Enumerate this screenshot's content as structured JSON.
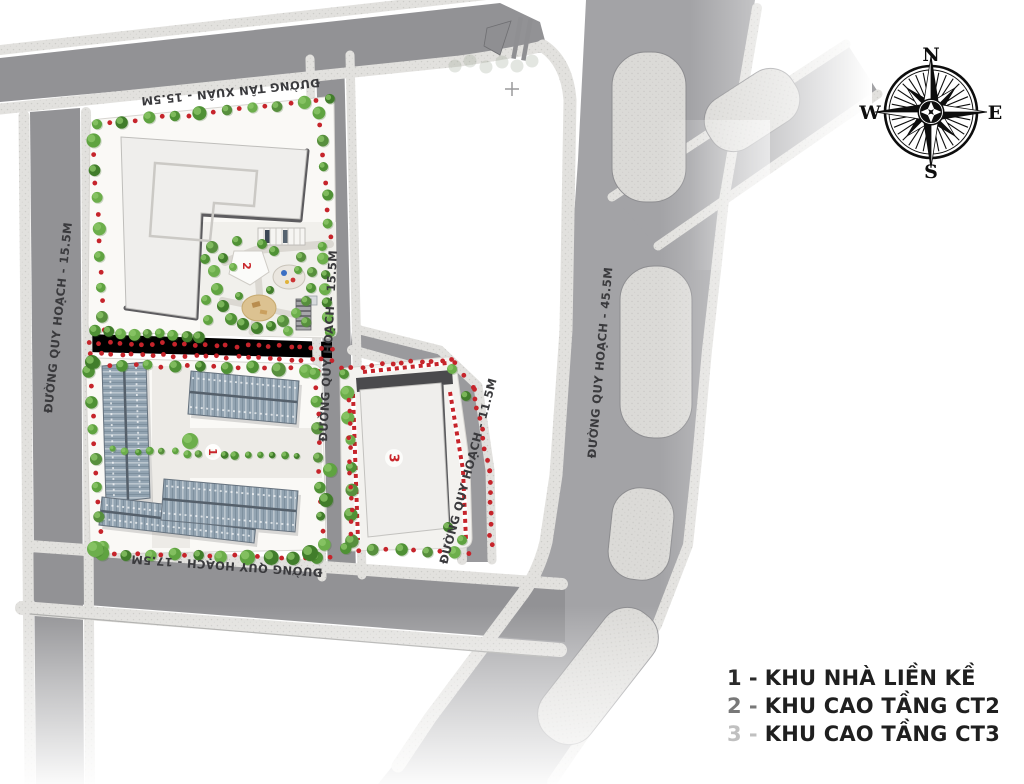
{
  "title": "Master plan site map",
  "roads": {
    "tan_xuan": "ĐƯỜNG TÂN XUÂN - 15.5M",
    "qh_15_left": "ĐƯỜNG QUY HOẠCH - 15.5M",
    "qh_15_mid": "ĐƯỜNG QUY HOẠCH - 15.5M",
    "qh_11": "ĐƯỜNG QUY HOẠCH - 11.5M",
    "qh_45": "ĐƯỜNG QUY HOẠCH - 45.5M",
    "qh_17": "ĐƯỜNG QUY HOẠCH - 17.5M"
  },
  "markers": {
    "block1": "1",
    "block2": "2",
    "block3": "3",
    "survey_cross": "+"
  },
  "legend": {
    "items": [
      {
        "num": "1",
        "sep": "-",
        "label": "KHU NHÀ LIỀN KỀ",
        "num_color": "#2a2a2a"
      },
      {
        "num": "2",
        "sep": "-",
        "label": "KHU CAO TẦNG CT2",
        "num_color": "#787878"
      },
      {
        "num": "3",
        "sep": "-",
        "label": "KHU CAO TẦNG CT3",
        "num_color": "#c0c0c0"
      }
    ]
  },
  "compass": {
    "n": "N",
    "e": "E",
    "s": "S",
    "w": "W"
  },
  "colors": {
    "marker_red": "#c9262b",
    "asphalt": "#97979a",
    "sidewalk": "#e2e1de",
    "tree_green": "#4f9135",
    "legend_text": "#1f1f1f"
  }
}
